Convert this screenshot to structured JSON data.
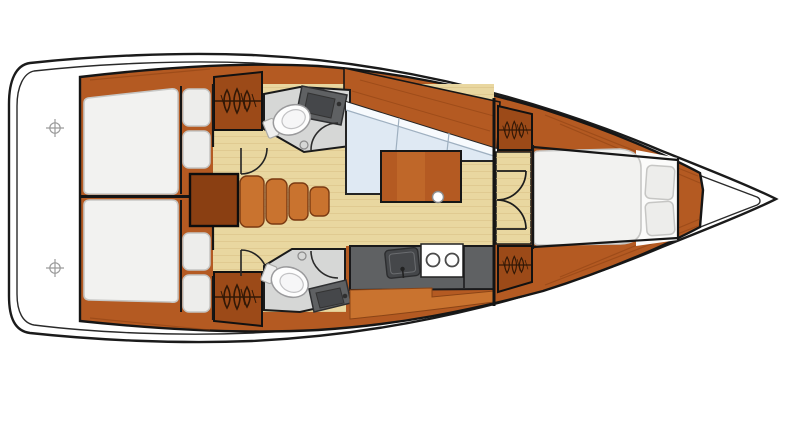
{
  "meta": {
    "title": "Sailboat interior layout - top-down floor plan, bow pointing right"
  },
  "colors": {
    "outline": "#1b1b1b",
    "hull_white": "#ffffff",
    "wood": "#b45a22",
    "wood_dark": "#9c4a18",
    "wood_deep": "#8a3f12",
    "wood_light": "#c9732f",
    "floor": "#e9d7a0",
    "plank": "#d9c084",
    "sofa": "#dfe9f3",
    "sofa_top": "#f7fafd",
    "bed": "#f2f2f0",
    "bed_edge": "#c7c7c5",
    "cushion": "#ededeb",
    "head_floor": "#d6d7d6",
    "counter": "#5f6163",
    "sink": "#45474a",
    "stove": "#ffffff",
    "burner": "#4a4a4a",
    "mark": "#9b9b9b",
    "icon_ink": "#241204"
  },
  "icons": {
    "hanging_locker": "clothes-rail-icon",
    "deck_mark": "crosshair-icon",
    "faucet": "faucet-icon",
    "burner": "burner-icon",
    "door": "door-arc"
  },
  "inventory": {
    "aft_cabins": 2,
    "heads": 2,
    "toilets": 2,
    "sinks": 3,
    "stove_burners": 2,
    "hanging_lockers": 4,
    "companionway_steps": 4,
    "berths": 3,
    "deck_marks": 2
  },
  "spaces": [
    {
      "id": "transom-platform",
      "label": "Stern platform"
    },
    {
      "id": "aft-cabin-port",
      "label": "Aft cabin port: double berth, locker, cushions"
    },
    {
      "id": "aft-cabin-starboard",
      "label": "Aft cabin starboard: double berth, locker, cushions"
    },
    {
      "id": "companionway",
      "label": "Companionway steps and engine box"
    },
    {
      "id": "head-port",
      "label": "Port head: toilet and vanity sink"
    },
    {
      "id": "head-starboard",
      "label": "Starboard head: toilet and vanity sink"
    },
    {
      "id": "saloon",
      "label": "Saloon: L-settee and table"
    },
    {
      "id": "galley",
      "label": "Galley: sink, two-burner stove, counters"
    },
    {
      "id": "forward-cabin",
      "label": "Forward cabin: island berth, lockers, double doors"
    }
  ]
}
